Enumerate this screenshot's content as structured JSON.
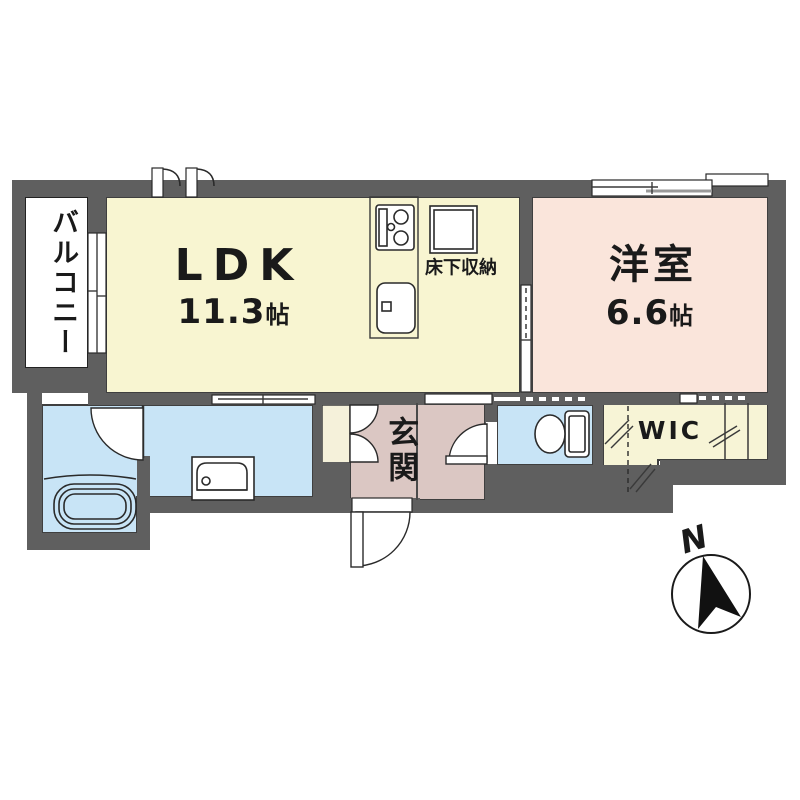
{
  "floorplan": {
    "balcony": {
      "label": "バルコニー"
    },
    "ldk": {
      "label": "LDK",
      "area": "11.3",
      "unit": "帖"
    },
    "western_room": {
      "label": "洋室",
      "area": "6.6",
      "unit": "帖"
    },
    "underfloor_storage": {
      "label": "床下収納"
    },
    "entrance": {
      "label": "玄関"
    },
    "walk_in_closet": {
      "label": "WIC"
    },
    "compass": {
      "label": "N"
    },
    "colors": {
      "wall": "#5f5f5f",
      "ldk_floor": "#f8f5d1",
      "western_room_floor": "#fae5db",
      "wet_area_floor": "#c8e4f6",
      "toilet_floor": "#c8e4f6",
      "entrance_floor": "#dbc7c3",
      "wic_floor": "#f7f4d6",
      "cabinet": "#f5f1da",
      "balcony_floor": "#ffffff"
    }
  }
}
